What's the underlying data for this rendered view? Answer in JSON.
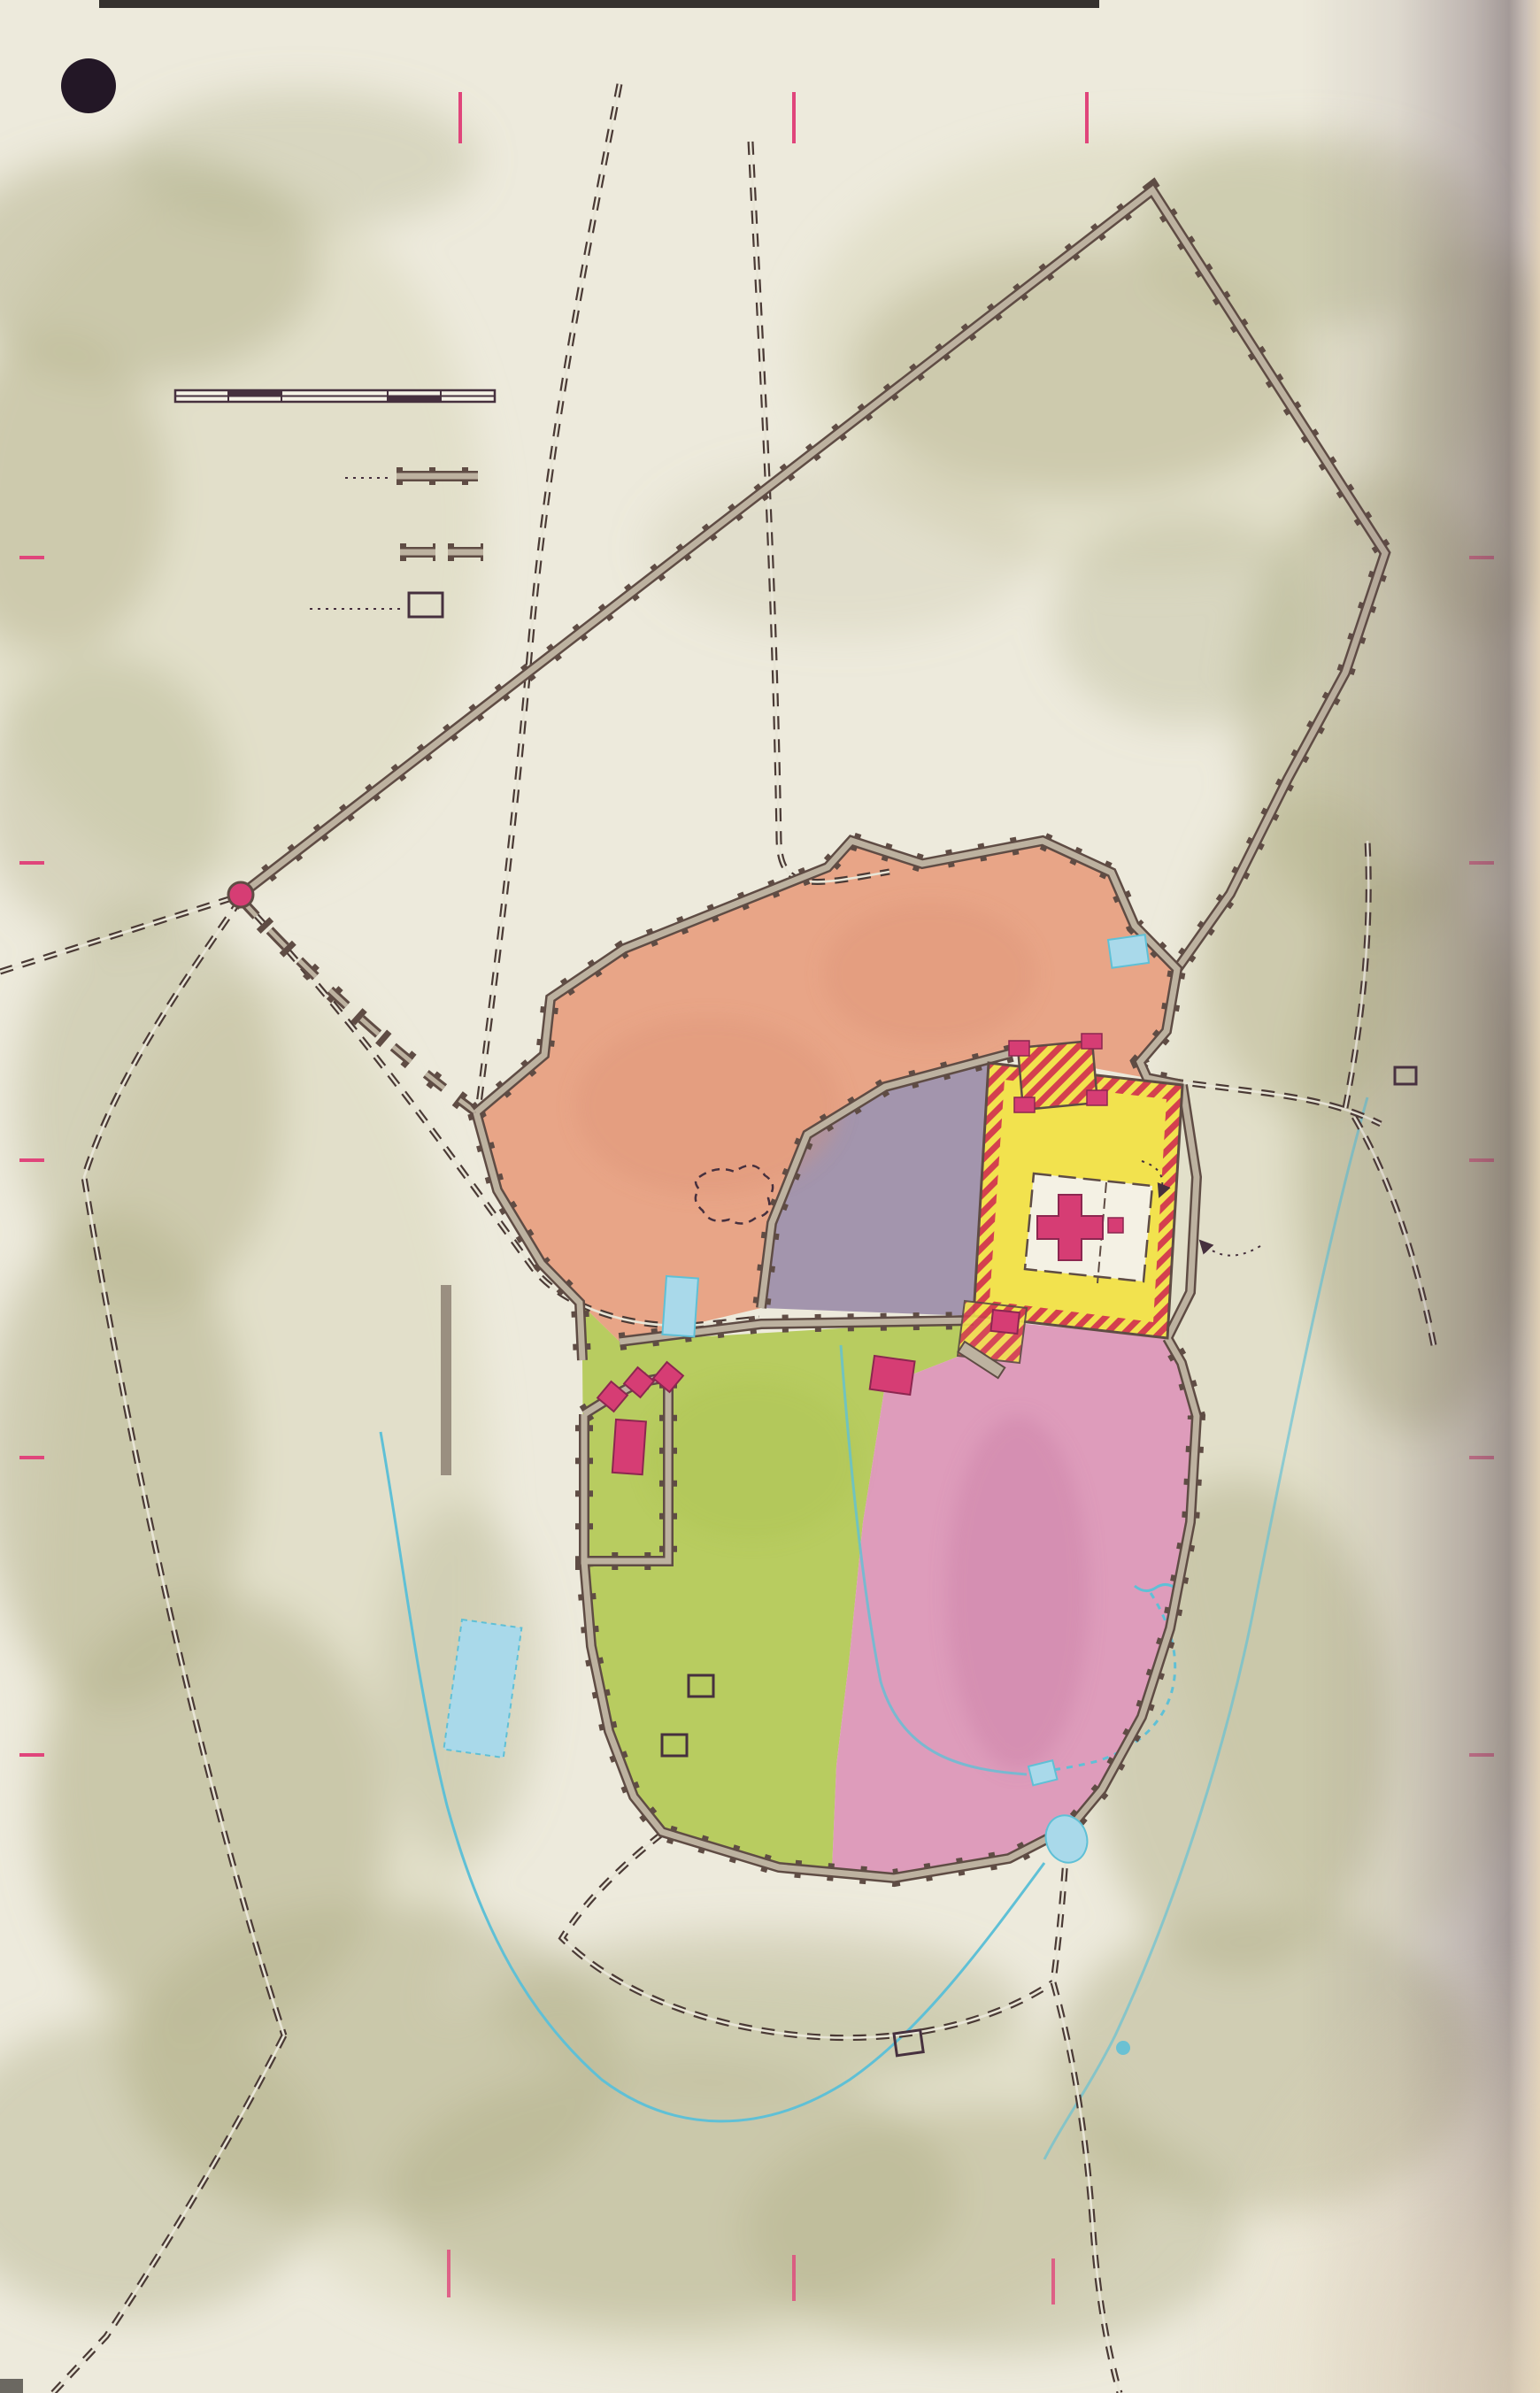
{
  "page": {
    "number": "10"
  },
  "grid": {
    "top": [
      "A",
      "B",
      "C",
      "D"
    ],
    "bottom": [
      "A",
      "B",
      "C",
      "D"
    ],
    "left": [
      "1",
      "2",
      "3",
      "4",
      "5",
      "6"
    ],
    "right": [
      "1",
      "2",
      "3",
      "4",
      "5",
      "6"
    ]
  },
  "title": {
    "line1": "JERUSALEM",
    "line2": "IN NEW TESTAMENT TIMES",
    "line3": "20 B.C. - 70 A.D.",
    "copyright": "Copyright by C. S. HAMMOND & CO., N. Y."
  },
  "legend": {
    "scale_title": "Scale of Feet",
    "scale_ticks": [
      "0",
      "500",
      "1000",
      "1500"
    ],
    "ancient_walls": "Ancient Walls",
    "theory_walls_1": "Location of walls",
    "theory_walls_2": "according to theory",
    "biblical_site_1": "Biblical site based",
    "biblical_site_2": "on tradition"
  },
  "note": {
    "l1": "Herod built the",
    "l2": "Towers of Hippicus (1),",
    "l3": "Phasael (2) and Mari-",
    "l4": "amne (3) to guard the",
    "l5": "western entrance to the",
    "l6": "city and his palace."
  },
  "labels": {
    "sychem1": "To Sychem and",
    "sychem2": "Damascus",
    "joppa1": "To",
    "joppa2": "Joppa",
    "psephinus1": "Psephinus",
    "psephinus2": "Tower ?",
    "third_wall": "Third North Wall? (Agrippa's Wall, c. 42 A.D.)",
    "hadrian": "(Hadrian's Wall, c. 135 A.D.)",
    "present_north": "Present  North  Wall",
    "second_north": "Second North Wall?",
    "bezetha": "BEZETHA",
    "bethesda1": "Pool of",
    "bethesda2": "Bethesda?",
    "antonia1": "Fortress of",
    "antonia2": "Antonia",
    "antonia3": "(Baris)",
    "sheep1": "Sheep",
    "sheep2": "Gate",
    "gethsemane1": "Garden of",
    "gethsemane2": "Gethsemane",
    "olives1": "To Mount",
    "olives2": "of Olives",
    "olives3": "and Bethany",
    "sepulchre1": "(Church of the",
    "sepulchre2": "Holy Sepulchre)",
    "sepulchre_cross": "+",
    "amygdalon1": "Pool of",
    "amygdalon2": "Amygdalon",
    "gennath1": "Gennath",
    "gennath2": "Gate",
    "suburb": "SUBURB",
    "council1": "Council",
    "council2": "House",
    "court_women1": "Court of",
    "court_women2": "Women",
    "herods": "Herod's",
    "temple": "Temple",
    "altar": "Altar",
    "solomons": "Solomon's Porch",
    "beautiful1": "Beautiful",
    "beautiful2": "Gate ?",
    "gentiles1": "Court of",
    "gentiles2": "Gentiles",
    "royal_porch": "Royal Porch",
    "huldah": "Huldah Gates",
    "xystus1": "Xystus",
    "xystus2": "(Market)",
    "bridge": "Bridge",
    "hasmonaean1": "Hasmonaean",
    "hasmonaean2": "Palace?",
    "palace1": "Palace",
    "palace2": "of",
    "palace3": "Herod",
    "tower1": "1.",
    "tower2": "2.",
    "tower3": "3.",
    "upper1": "UPPER",
    "upper2": "CITY",
    "lower1": "LOWER",
    "lower2": "CITY",
    "tyropoeon": "Tyropoeon Valley",
    "kidron": "Valley of the Kidron",
    "spring_gihon": "Spring Gihon",
    "tunnel": "Tunnel of Hezekiah",
    "caiaphas1": "House of",
    "caiaphas2": "Caiaphas",
    "supper1": "House of the",
    "supper2": "Last Supper",
    "serpents": "Serpent's Pool",
    "essene1": "Essene",
    "essene2": "Gate",
    "pilates": "Pilate's Aqueduct",
    "hinnom": "Valley of Hinnom",
    "siloam": "Pool of Siloam",
    "oldpool1": "Lower or",
    "oldpool2": "Old Pool",
    "aceldama1": "Aceldama or",
    "aceldama2": "Field of Blood",
    "enrogel1": "En-rogel",
    "enrogel2": "(Spring)",
    "bethlehem1": "To Bethlehem",
    "bethlehem2": "and Hebron",
    "salt_sea": "To the Salt Sea"
  },
  "colors": {
    "paper": "#edeadc",
    "hills": "#b3b18c",
    "bezetha": "#e8a587",
    "suburb": "#a395ad",
    "upper_city": "#b8cc60",
    "lower_city": "#de9cbb",
    "temple_court": "#f2e24e",
    "inner_court": "#f4f1e4",
    "wall_fill": "#bdb2a0",
    "wall_edge": "#5f4c44",
    "pool": "#a9d9ea",
    "water_label": "#2fa3c2",
    "blue_label": "#667cc2",
    "building": "#d63d74",
    "accent_pink": "#e0457b",
    "ink": "#46303e",
    "stripe_red": "#d4404e"
  }
}
